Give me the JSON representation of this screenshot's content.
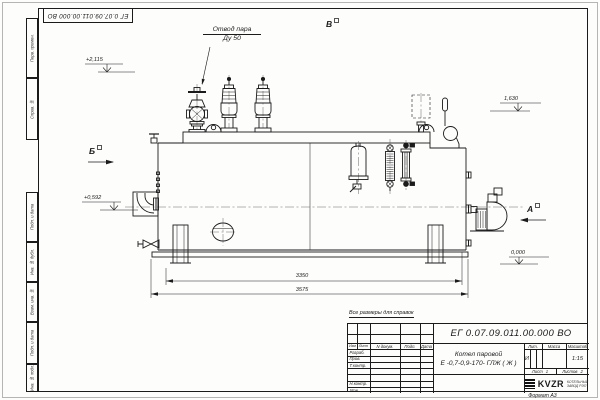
{
  "top_stamp": {
    "doc_number": "ЕГ 0.07.09.011.00.000 ВО"
  },
  "margin_labels": {
    "perv_primen": "Перв. примен.",
    "sprav_no": "Справ. №",
    "podp_data_1": "Подп. и дата",
    "inv_dubl": "Инв. № дубл.",
    "vzam_inv": "Взам. инв. №",
    "podp_data_2": "Подп. и дата",
    "inv_podl": "Инв. № подл."
  },
  "callout": {
    "line1": "Отвод пара",
    "line2": "Ду 50"
  },
  "views": {
    "a": "А",
    "b": "Б",
    "v": "В"
  },
  "elevations": {
    "top_left": "+2,115",
    "right": "1,630",
    "mid_left": "+0,592",
    "zero": "0,000"
  },
  "dimensions": {
    "inner": "3350",
    "outer": "3575"
  },
  "note": "Все размеры для справок",
  "title_block": {
    "doc_number": "ЕГ 0.07.09.011.00.000 ВО",
    "product_line1": "Котел паровой",
    "product_line2": "Е -0,7-0,9-170- ГЛЖ ( Ж )",
    "header_izm": "Изм",
    "header_list": "Лист",
    "header_ndoc": "N докум.",
    "header_podp": "Подп.",
    "header_data": "Дата",
    "row_razrab": "Разраб.",
    "row_prov": "Пров.",
    "row_tkontr": "Т.контр.",
    "row_nkontr": "Н.контр.",
    "row_utv": "Утв.",
    "lit_header": "Лит.",
    "mass_header": "Масса",
    "scale_header": "Масштаб",
    "lit_value": "И",
    "scale_value": "1:15",
    "sheet_label": "Лист",
    "sheet_value": "1",
    "sheets_label": "Листов",
    "sheets_value": "2",
    "company_abbr": "KVZR",
    "company_line1": "КОТЕЛЬНЫЙ",
    "company_line2": "ЗАВОД РЭП",
    "format_label": "Формат А3"
  }
}
